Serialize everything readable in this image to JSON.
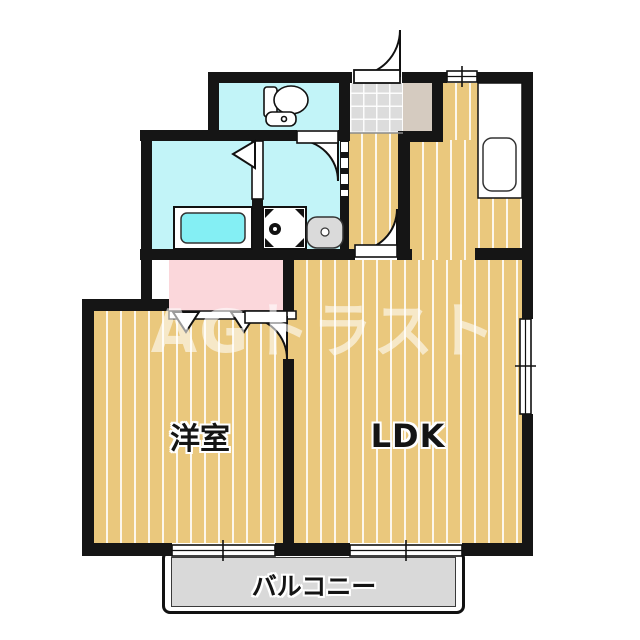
{
  "watermark": {
    "text": "AGトラスト"
  },
  "rooms": {
    "western_room": {
      "label": "洋室"
    },
    "ldk": {
      "label": "LDK"
    },
    "balcony": {
      "label": "バルコニー"
    },
    "bathroom": {
      "label": ""
    },
    "washroom": {
      "label": ""
    },
    "toilet": {
      "label": ""
    },
    "entrance": {
      "label": ""
    },
    "closet": {
      "label": ""
    }
  },
  "fixtures": [
    "toilet-icon",
    "bathtub-icon",
    "washing-machine-pan-icon",
    "washbasin-icon",
    "kitchen-counter",
    "kitchen-sink-icon",
    "entrance-swing-door",
    "toilet-swing-door",
    "bathroom-folding-door",
    "washroom-dashed-opening",
    "hallway-swing-door",
    "western-room-swing-door",
    "closet-folding-doors",
    "kitchen-window",
    "side-window",
    "balcony-sliding-window-left",
    "balcony-sliding-window-right"
  ],
  "colors": {
    "wall": "#151515",
    "flooring": "#EAC87D",
    "floor_stripe": "#FFFFFF",
    "wet_area": "#C2F4F8",
    "bathtub_water": "#84EFF4",
    "closet_pink": "#FBD7DB",
    "entrance_tile": "#DCDCDC",
    "shoe_cabinet": "#D5CBC0",
    "balcony_gray": "#D9D9D9",
    "watermark_white": "rgba(255,255,255,0.58)"
  }
}
